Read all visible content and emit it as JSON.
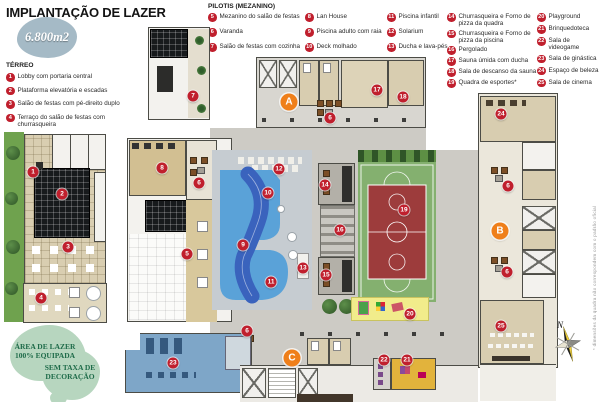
{
  "title": "IMPLANTAÇÃO DE LAZER",
  "area_badge": "6.800m2",
  "legend_terreo": {
    "header": "TÉRREO",
    "items": [
      {
        "n": "1",
        "label": "Lobby com portaria central"
      },
      {
        "n": "2",
        "label": "Plataforma elevatória e escadas"
      },
      {
        "n": "3",
        "label": "Salão de festas com pé-direito duplo"
      },
      {
        "n": "4",
        "label": "Terraço do salão de festas com churrasqueira"
      }
    ]
  },
  "legend_pilotis": {
    "header": "PILOTIS (MEZANINO)",
    "columns": [
      [
        {
          "n": "5",
          "label": "Mezanino do salão de festas"
        },
        {
          "n": "6",
          "label": "Varanda"
        },
        {
          "n": "7",
          "label": "Salão de festas com cozinha"
        }
      ],
      [
        {
          "n": "8",
          "label": "Lan House"
        },
        {
          "n": "9",
          "label": "Piscina adulto com raia"
        },
        {
          "n": "10",
          "label": "Deck molhado"
        }
      ],
      [
        {
          "n": "11",
          "label": "Piscina infantil"
        },
        {
          "n": "12",
          "label": "Solarium"
        },
        {
          "n": "13",
          "label": "Ducha e lava-pés"
        }
      ],
      [
        {
          "n": "14",
          "label": "Churrasqueira e Forno de pizza da quadra"
        },
        {
          "n": "15",
          "label": "Churrasqueira e Forno de pizza da piscina"
        },
        {
          "n": "16",
          "label": "Pergolado"
        },
        {
          "n": "17",
          "label": "Sauna úmida com ducha"
        },
        {
          "n": "18",
          "label": "Sala de descanso da sauna"
        },
        {
          "n": "19",
          "label": "Quadra de esportes*"
        }
      ],
      [
        {
          "n": "20",
          "label": "Playground"
        },
        {
          "n": "21",
          "label": "Brinquedoteca"
        },
        {
          "n": "22",
          "label": "Sala de videogame"
        },
        {
          "n": "23",
          "label": "Sala de ginástica"
        },
        {
          "n": "24",
          "label": "Espaço de beleza"
        },
        {
          "n": "25",
          "label": "Sala de cinema"
        }
      ]
    ]
  },
  "promo_badges": {
    "badge1_line1": "ÁREA DE LAZER",
    "badge1_line2": "100% EQUIPADA",
    "badge2_line1": "SEM TAXA DE",
    "badge2_line2": "DECORAÇÃO"
  },
  "compass": {
    "north_label": "N"
  },
  "footnote": "* dimensões da quadra não correspondem com o padrão oficial",
  "plan_markers": [
    {
      "n": "7",
      "x": 193,
      "y": 96,
      "kind": "red"
    },
    {
      "n": "17",
      "x": 377,
      "y": 90,
      "kind": "red"
    },
    {
      "n": "18",
      "x": 403,
      "y": 97,
      "kind": "red"
    },
    {
      "n": "A",
      "x": 289,
      "y": 102,
      "kind": "zone"
    },
    {
      "n": "24",
      "x": 501,
      "y": 114,
      "kind": "red"
    },
    {
      "n": "6",
      "x": 330,
      "y": 118,
      "kind": "red"
    },
    {
      "n": "8",
      "x": 162,
      "y": 168,
      "kind": "red"
    },
    {
      "n": "12",
      "x": 279,
      "y": 169,
      "kind": "red"
    },
    {
      "n": "6",
      "x": 199,
      "y": 183,
      "kind": "red"
    },
    {
      "n": "14",
      "x": 325,
      "y": 185,
      "kind": "red"
    },
    {
      "n": "6",
      "x": 508,
      "y": 186,
      "kind": "red"
    },
    {
      "n": "10",
      "x": 268,
      "y": 193,
      "kind": "red"
    },
    {
      "n": "19",
      "x": 404,
      "y": 210,
      "kind": "red"
    },
    {
      "n": "16",
      "x": 340,
      "y": 230,
      "kind": "red"
    },
    {
      "n": "B",
      "x": 500,
      "y": 231,
      "kind": "zone"
    },
    {
      "n": "9",
      "x": 243,
      "y": 245,
      "kind": "red"
    },
    {
      "n": "5",
      "x": 187,
      "y": 254,
      "kind": "red"
    },
    {
      "n": "13",
      "x": 303,
      "y": 268,
      "kind": "red"
    },
    {
      "n": "6",
      "x": 507,
      "y": 272,
      "kind": "red"
    },
    {
      "n": "15",
      "x": 326,
      "y": 275,
      "kind": "red"
    },
    {
      "n": "11",
      "x": 271,
      "y": 282,
      "kind": "red"
    },
    {
      "n": "20",
      "x": 410,
      "y": 314,
      "kind": "red"
    },
    {
      "n": "25",
      "x": 501,
      "y": 326,
      "kind": "red"
    },
    {
      "n": "6",
      "x": 247,
      "y": 331,
      "kind": "red"
    },
    {
      "n": "C",
      "x": 292,
      "y": 358,
      "kind": "zone"
    },
    {
      "n": "22",
      "x": 384,
      "y": 360,
      "kind": "red"
    },
    {
      "n": "21",
      "x": 407,
      "y": 360,
      "kind": "red"
    },
    {
      "n": "23",
      "x": 173,
      "y": 363,
      "kind": "red"
    },
    {
      "n": "1",
      "x": 33,
      "y": 172,
      "kind": "red"
    },
    {
      "n": "2",
      "x": 62,
      "y": 194,
      "kind": "red"
    },
    {
      "n": "3",
      "x": 68,
      "y": 247,
      "kind": "red"
    },
    {
      "n": "4",
      "x": 41,
      "y": 298,
      "kind": "red"
    }
  ],
  "colors": {
    "legend_red": "#c01f2d",
    "zone_orange": "#ef7f1a",
    "pool_light": "#5aa2d8",
    "pool_dark": "#3a63bd",
    "court_green": "#84b06f",
    "court_red": "#9d3c3c",
    "gym_blue": "#7ea6c8",
    "playground_yellow": "#f1ec8b",
    "badge_blue": "#a5bac6",
    "promo_blob_green": "#b7d6bf",
    "promo_text_green": "#1e6b49",
    "grass_green": "#6fa24e"
  }
}
